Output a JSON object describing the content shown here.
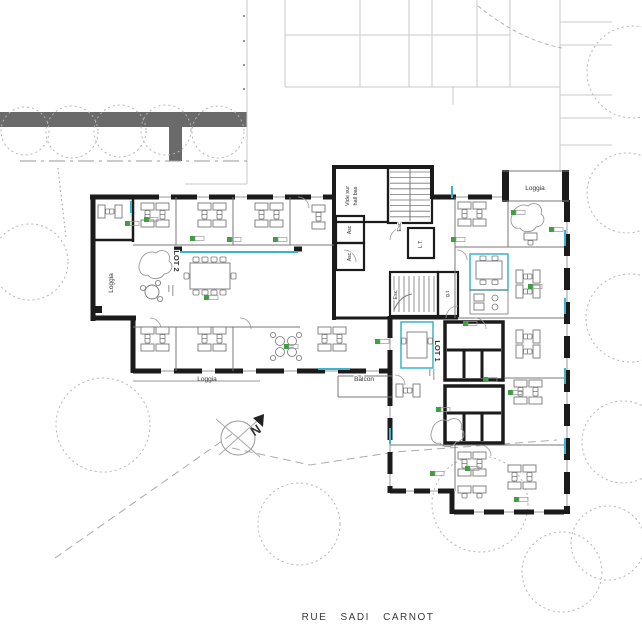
{
  "street_label": "RUE SADI CARNOT",
  "compass": {
    "north": "N"
  },
  "lots": {
    "lot1": "LOT 1",
    "lot2": "LOT 2"
  },
  "rooms": {
    "loggia_left": "Loggia",
    "loggia_top_right": "Loggia",
    "loggia_bottom": "Loggia",
    "balcon": "Balcon",
    "vide_line1": "Vide sur",
    "vide_line2": "hall bas",
    "esc_top": "Esc",
    "esc_bottom": "Esc",
    "asc_top": "Asc",
    "asc_bottom": "Asc",
    "lt": "L.T.",
    "gt": "g.t"
  },
  "colors": {
    "wall": "#1b1b1b",
    "partition": "#777777",
    "thin": "#999999",
    "light_line": "#c9c9c9",
    "road": "#6a6a6a",
    "glass": "#3ab4c8",
    "plant": "#3f9e3f",
    "tree": "#b5b5b5",
    "dash": "#aaaaaa",
    "text": "#333333"
  }
}
